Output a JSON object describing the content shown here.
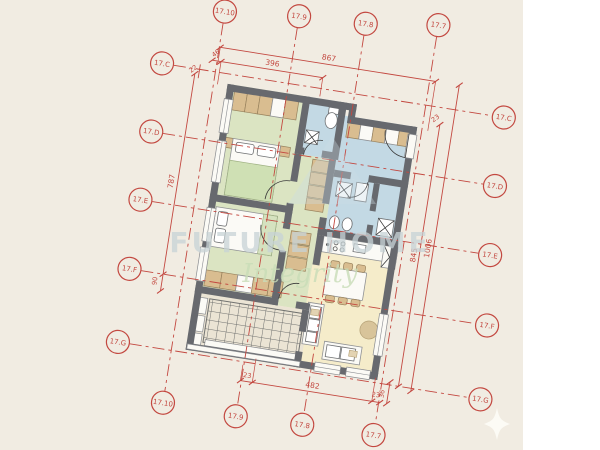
{
  "image_type": "apartment floor plan drawing",
  "grid_markers": {
    "top": [
      "17.10",
      "17.9",
      "17.8",
      "17.7"
    ],
    "bottom": [
      "17.10",
      "17.9",
      "17.8",
      "17.7"
    ],
    "left": [
      "17.C",
      "17.D",
      "17.E",
      "17.F",
      "17.G"
    ],
    "right": [
      "17.C",
      "17.D",
      "17.E",
      "17.F",
      "17.G"
    ]
  },
  "dimensions": {
    "top_total": "867",
    "top_segment": "396",
    "top_offset": "46",
    "left_offset_top": "22",
    "left_height": "787",
    "left_offset_bottom": "90",
    "right_inner_height": "845",
    "right_total_height": "1006",
    "right_offset_top": "23",
    "bottom_offset_left": "23",
    "bottom_segment": "482",
    "bottom_offset_right": "23",
    "bottom_side": "36"
  },
  "watermark": {
    "brand_line": "FUTURE HOME",
    "tagline": "Integrity"
  },
  "colors": {
    "annotation_red": "#c34840",
    "wall_gray": "#67696e",
    "bedroom_green": "#dbe4c2",
    "bath_blue": "#c3d9e4",
    "living_cream": "#f5ecca",
    "terrace_beige": "#ebe4d4",
    "background_beige": "#f1ece2",
    "furniture_tan": "#d9bd90"
  }
}
